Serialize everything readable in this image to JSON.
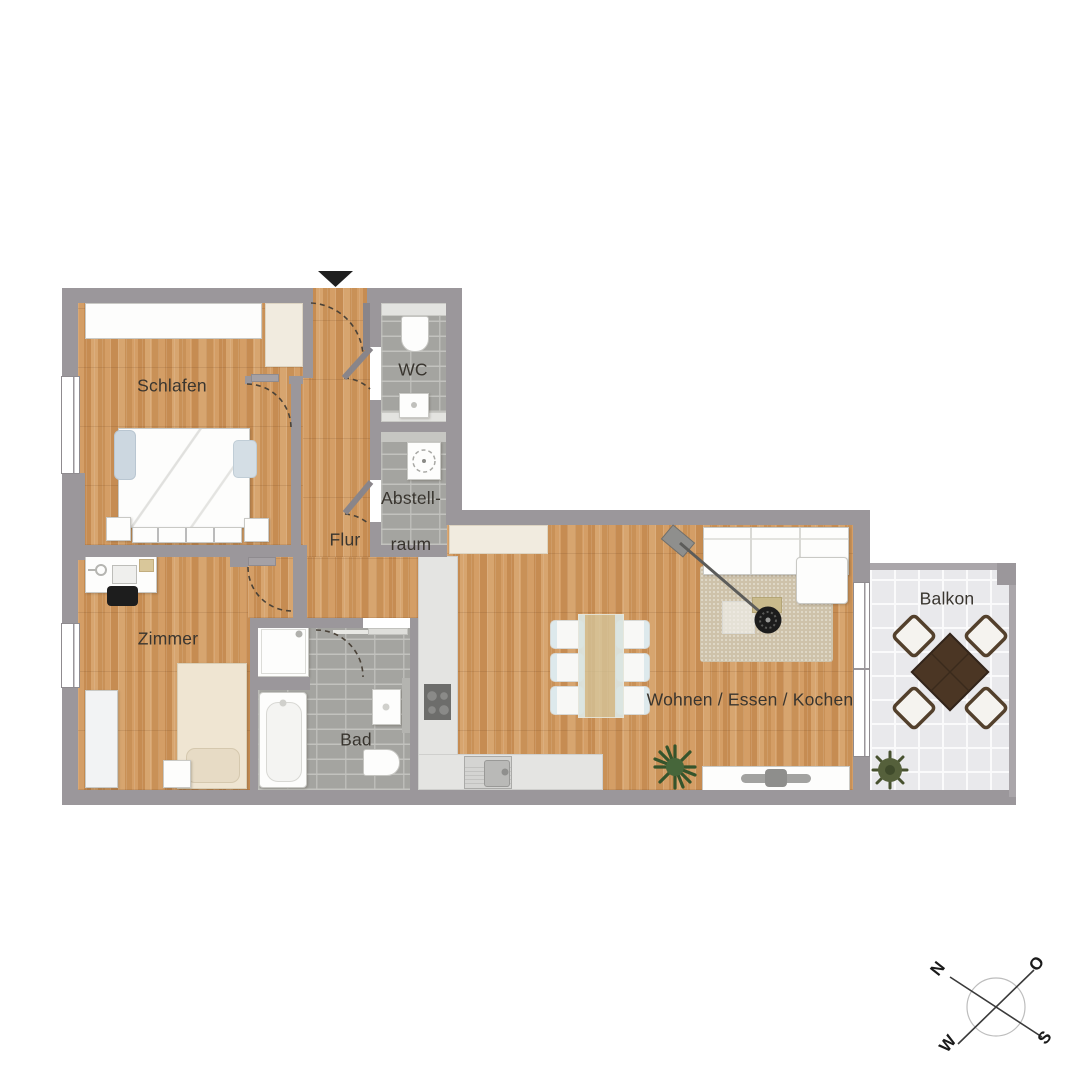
{
  "plan": {
    "title": "apartment-floor-plan",
    "rooms": {
      "schlafen": {
        "label": "Schlafen"
      },
      "zimmer": {
        "label": "Zimmer"
      },
      "flur": {
        "label": "Flur"
      },
      "wc": {
        "label": "WC"
      },
      "abstellraum": {
        "line1": "Abstell-",
        "line2": "raum"
      },
      "bad": {
        "label": "Bad"
      },
      "wohnen": {
        "label": "Wohnen / Essen / Kochen"
      },
      "balkon": {
        "label": "Balkon"
      }
    },
    "compass": {
      "n": "N",
      "o": "O",
      "s": "S",
      "w": "W"
    },
    "colors": {
      "wall": "#9b979b",
      "wood_floor": "#cd9760",
      "bath_tile": "#a4a4a0",
      "balcony_tile": "#e9e9ec",
      "entrance_marker": "#1f1f1f",
      "label_text": "#39352f"
    }
  }
}
